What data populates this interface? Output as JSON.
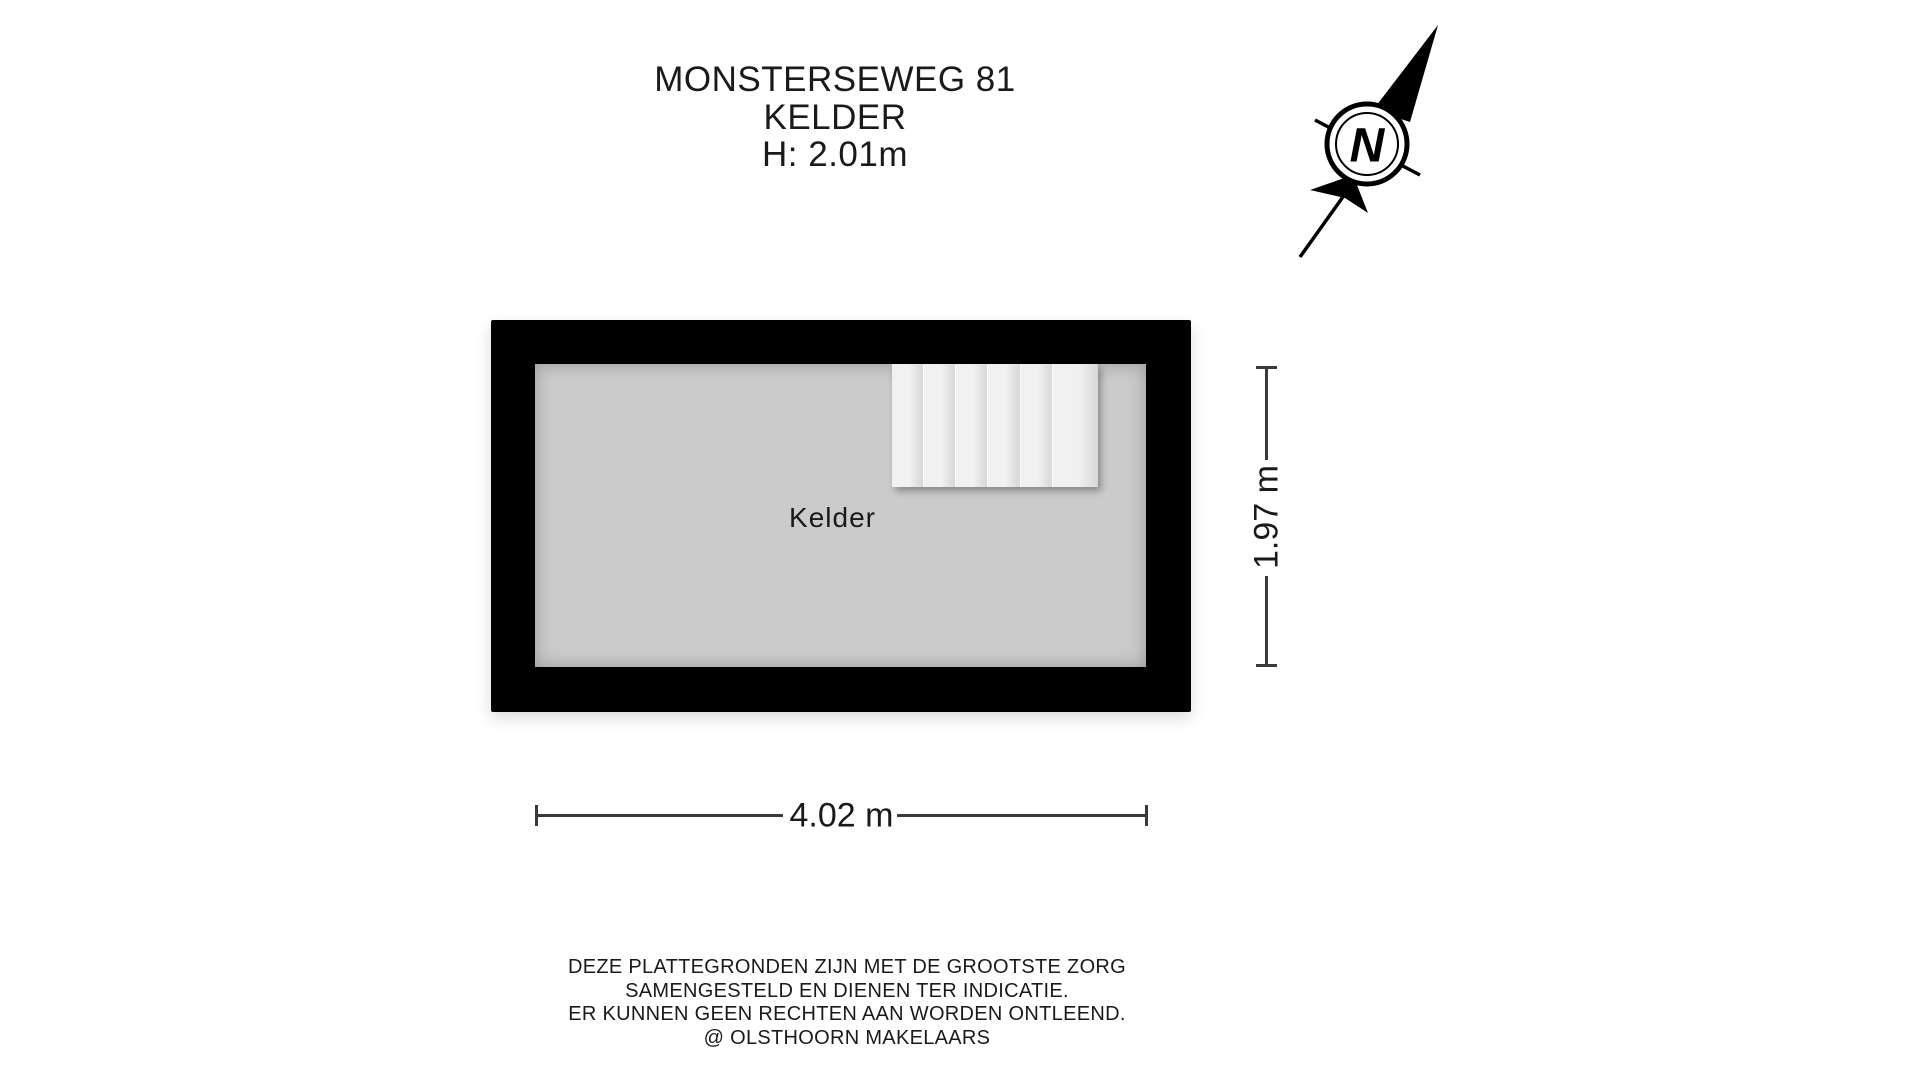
{
  "title": {
    "address": "MONSTERSEWEG 81",
    "floor": "KELDER",
    "ceiling_height": "H: 2.01m"
  },
  "compass": {
    "north_label": "N"
  },
  "floorplan": {
    "room_label": "Kelder",
    "width_dimension": "4.02 m",
    "height_dimension": "1.97 m",
    "stair_tread_count": 6
  },
  "disclaimer": {
    "line1": "DEZE PLATTEGRONDEN ZIJN MET DE GROOTSTE ZORG",
    "line2": "SAMENGESTELD EN DIENEN TER INDICATIE.",
    "line3": "ER KUNNEN GEEN RECHTEN AAN WORDEN ONTLEEND.",
    "line4": "@ OLSTHOORN MAKELAARS"
  },
  "colors": {
    "wall": "#000000",
    "floor": "#cbcbcb",
    "stair": "#f1f1f1",
    "dim": "#3a3a3a",
    "text": "#1a1a1a"
  }
}
